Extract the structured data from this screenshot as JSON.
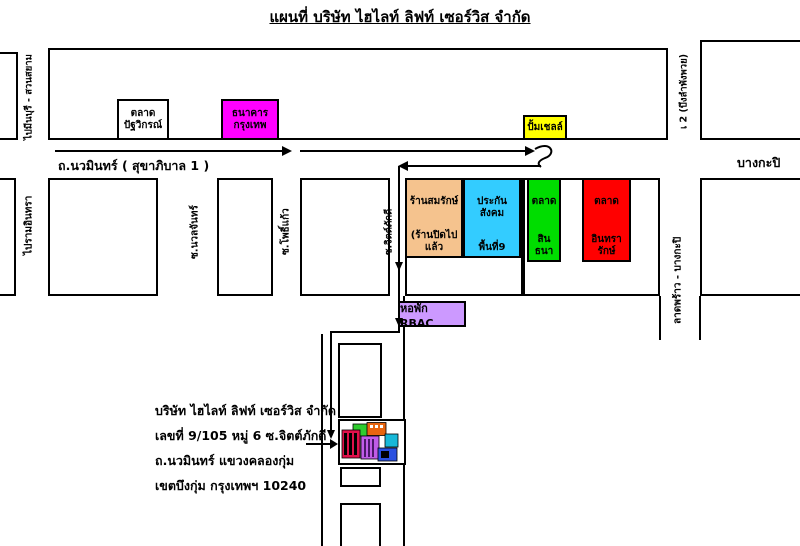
{
  "title": "แผนที่  บริษัท ไฮไลท์ ลิฟท์ เซอร์วิส จำกัด",
  "roads": {
    "nawamin": "ถ.นวมินทร์ ( สุขาภิบาล 1 )",
    "bangkapi": "บางกะปิ",
    "to_minburi_suansiam": "ไปมีนบุรี - สวนสยาม",
    "to_ramindra": "ไปรามอินทรา",
    "top_right_road": "เ 2 (บึงลำพังพวย)",
    "soi_nuanchan": "ซ.นวลจันทร์",
    "soi_phokaew": "ซ.โพธิ์แก้ว",
    "soi_chitphakdi": "ซ.จิตต์ภักดี",
    "ladprao_bangkapi": "ลาดพร้าว - บางกะปิ"
  },
  "places": {
    "pattawikorn_market": {
      "line1": "ตลาด",
      "line2": "ปัฐวิกรณ์",
      "bg": "#FFFFFF"
    },
    "bangkok_bank": {
      "line1": "ธนาคาร",
      "line2": "กรุงเทพ",
      "bg": "#FF00FF"
    },
    "shell_station": {
      "label": "ปั้มเชลล์",
      "bg": "#FFFF00"
    },
    "somrak_shop": {
      "line1": "ร้านสมรักษ์",
      "line2": "(ร้านปิดไปแล้ว",
      "bg": "#F5C38E"
    },
    "social_security_area9": {
      "line1": "ประกันสังคม",
      "line2": "พื้นที่9",
      "bg": "#33CCFF"
    },
    "sinthana_market": {
      "line1": "ตลาด",
      "line2": "สินธนา",
      "bg": "#00DD00"
    },
    "intharak_market": {
      "line1": "ตลาด",
      "line2": "อินทรารักษ์",
      "bg": "#FF0000"
    },
    "rbac_dormitory": {
      "label": "หอพัก RBAC",
      "bg": "#CC99FF"
    }
  },
  "address": {
    "line1": "บริษัท ไฮไลท์ ลิฟท์ เซอร์วิส จำกัด",
    "line2": "เลขที่ 9/105 หมู่ 6 ซ.จิตต์ภักดี",
    "line3": "ถ.นวมินทร์ แขวงคลองกุ่ม",
    "line4": "เขตบึงกุ่ม กรุงเทพฯ 10240"
  }
}
